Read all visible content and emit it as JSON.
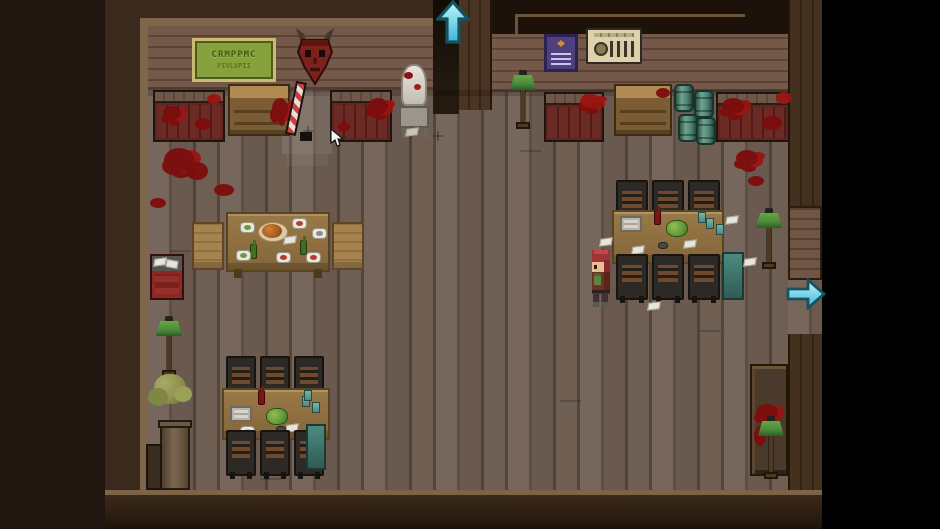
{
  "scene": {
    "name": "top-down-pixel-rpg-tavern-interior",
    "description": "Blood-spattered tavern dining hall viewed from above, wooden plank floor, letterboxed game viewport",
    "sign": {
      "line1": "CRMPPMC",
      "line2": "PIVLVPII"
    },
    "exits": [
      {
        "id": "exit-up",
        "direction": "up",
        "marker": "cyan-arrow"
      },
      {
        "id": "exit-right",
        "direction": "right",
        "marker": "cyan-arrow"
      }
    ],
    "player": {
      "sprite": "red-haired-adventurer",
      "facing": "left"
    },
    "cursor": {
      "visible": true
    },
    "objects": [
      "green-wall-sign",
      "demon-mask",
      "candy-cane-staff",
      "bloody-bench",
      "wall-cabinet",
      "white-statue",
      "purple-poster",
      "beige-control-panel",
      "teal-barrels",
      "floor-lamp",
      "dining-table-with-food",
      "long-table-with-chairs",
      "side-chair",
      "dark-chair",
      "red-crate",
      "potted-plant",
      "tall-cabinet-bloody",
      "teal-bin",
      "blood-stain",
      "paper-scrap",
      "roast-platter",
      "wine-bottle",
      "cabbage",
      "plate"
    ],
    "colors": {
      "letterbox_left": "#20160f",
      "letterbox_right": "#000000",
      "outer_wall": "#3a2a1d",
      "frame": "#7f6549",
      "wall_plank": "#74584a",
      "wall_plank_dark": "#5c4335",
      "floor_plank": "#6f5e52",
      "floor_seam": "#55463a",
      "blood": "#7d0d0d",
      "blood_bright": "#9b1410",
      "arrow_fill_light": "#bdf6fb",
      "arrow_fill_dark": "#3fb4da",
      "arrow_outline": "#15535f",
      "lamp_green": "#4a8a3c",
      "table_wood": "#9a7947",
      "table_edge": "#5a431f",
      "chair_slat": "#6f4a2c",
      "chair_light": "#a5824e",
      "bench_rail": "#6f574a",
      "sign_bg": "#87a23c",
      "sign_border": "#c9bc72",
      "sign_text": "#3f5c10",
      "poster_purple": "#4e3f7e",
      "panel_beige": "#ded2ac",
      "barrel_teal": "#4e8274",
      "mask_red": "#7c211b",
      "player_hair": "#a03338",
      "player_coat": "#713026",
      "player_bag": "#5d8441",
      "crate_red": "#8c2824",
      "cabinet_wood": "#b08a52"
    }
  }
}
